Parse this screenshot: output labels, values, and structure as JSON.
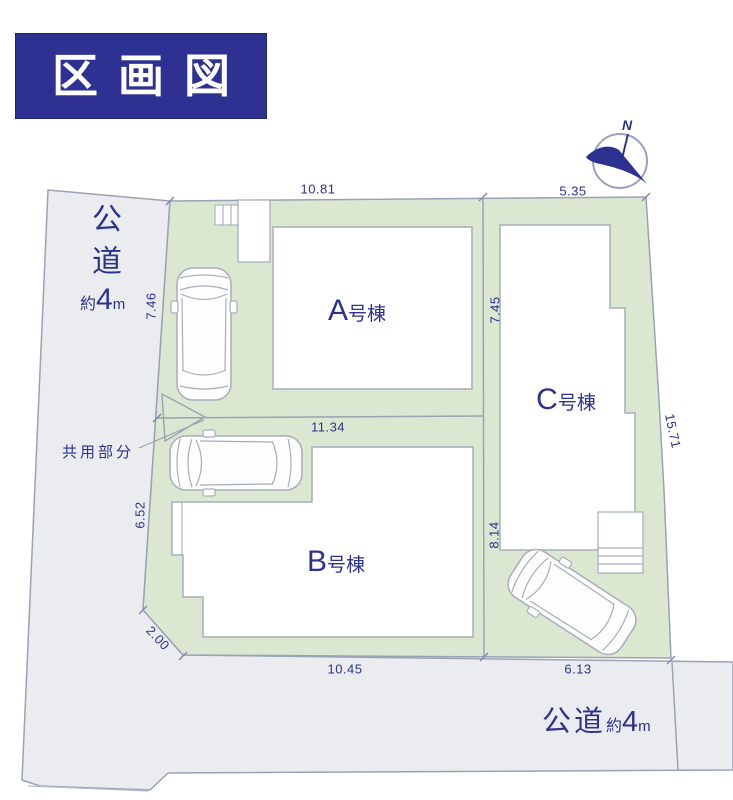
{
  "title": "区画図",
  "compass": {
    "north": "N"
  },
  "roads": {
    "left": {
      "name": "公道",
      "approx": "約",
      "width_value": "4",
      "unit": "m"
    },
    "bottom": {
      "name": "公道",
      "approx": "約",
      "width_value": "4",
      "unit": "m"
    }
  },
  "common_area_label": "共用部分",
  "buildings": [
    {
      "letter": "A",
      "suffix": "号棟"
    },
    {
      "letter": "B",
      "suffix": "号棟"
    },
    {
      "letter": "C",
      "suffix": "号棟"
    }
  ],
  "dimensions": {
    "top_a": "10.81",
    "top_c": "5.35",
    "left_upper": "7.46",
    "a_c_boundary": "7.45",
    "right_side": "15.71",
    "b_top": "11.34",
    "left_lower": "6.52",
    "b_c_boundary": "8.14",
    "corner_chamfer": "2.00",
    "bottom_b": "10.45",
    "bottom_c": "6.13"
  },
  "colors": {
    "title_bg": "#2e3192",
    "text_navy": "#2d3190",
    "land_green": "#dbe7d0",
    "road_gray": "#ebecf0",
    "line_gray": "#9aa2b4"
  }
}
